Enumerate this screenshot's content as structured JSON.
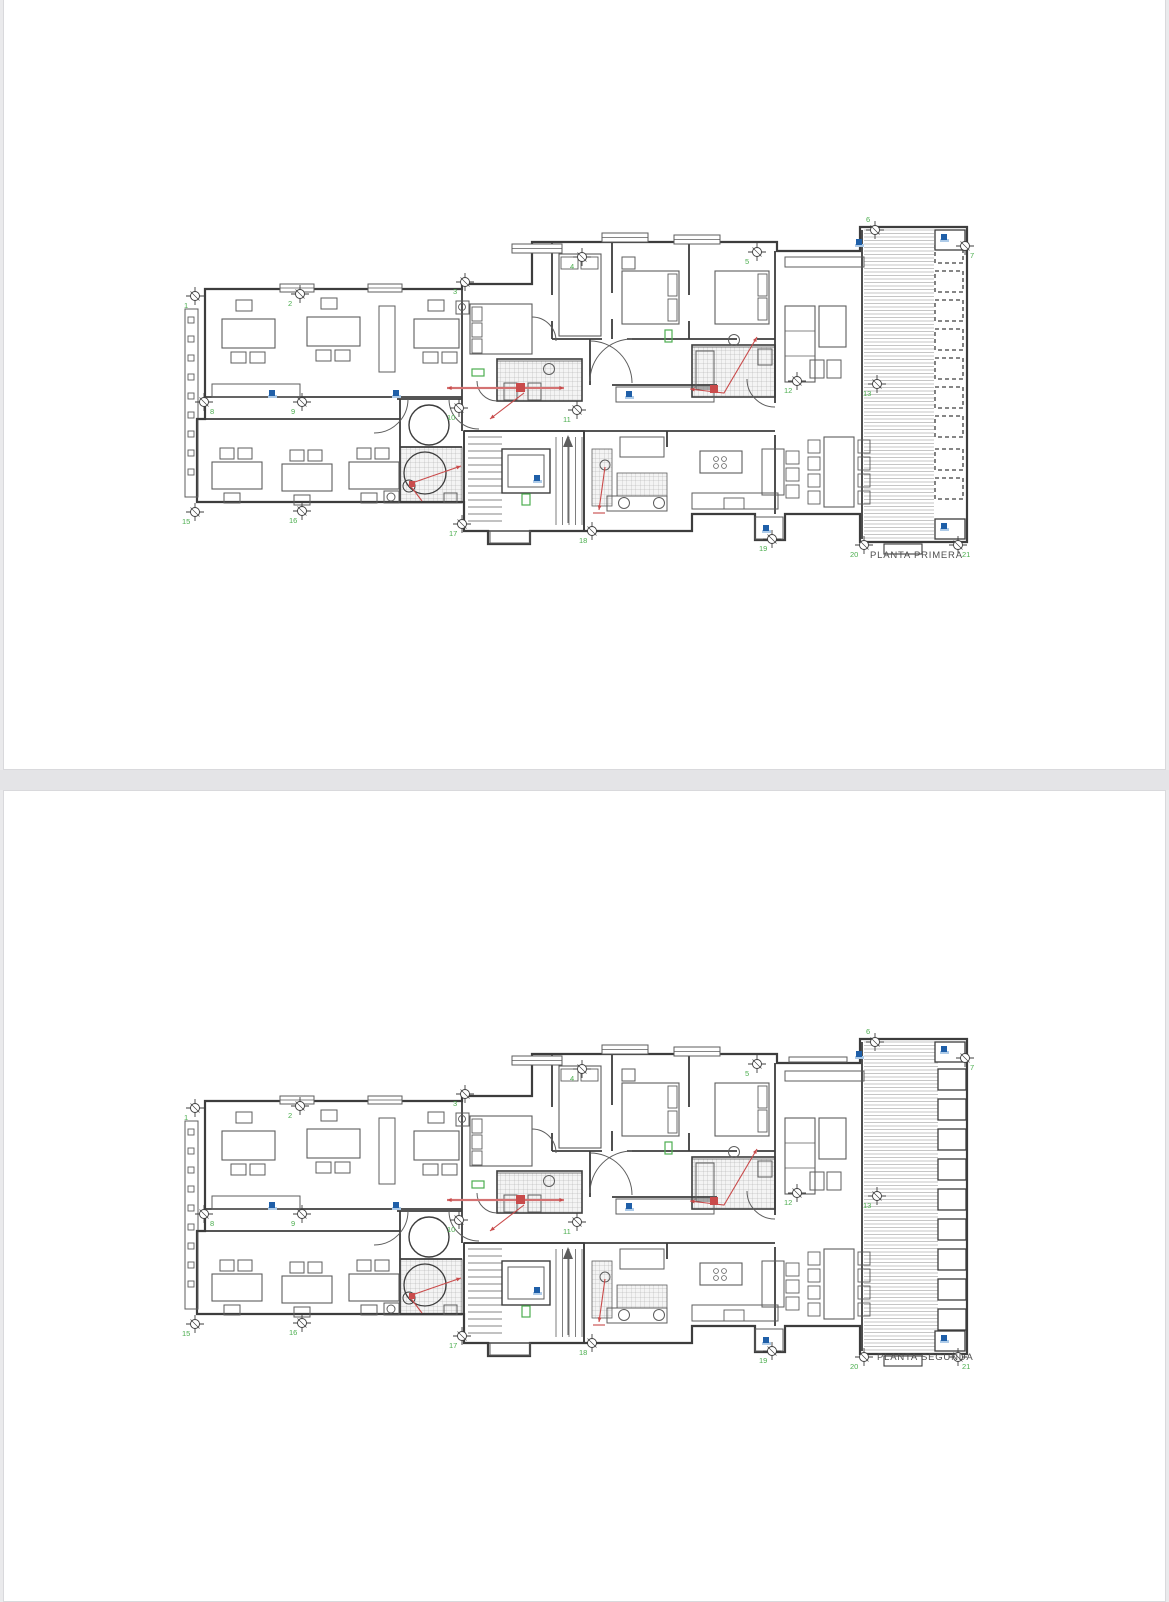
{
  "colors": {
    "wall_line": "#3d3d3d",
    "furniture_line": "#5d5d5d",
    "grid_green": "#4cae4f",
    "annotation_red": "#c94b4b",
    "annotation_red_light": "#e09a9a",
    "marker_blue": "#1f5fa8",
    "marker_blue_light": "#aecbe8",
    "hatch_line": "#a9a9a9",
    "hatch_bg": "#f4f4f4",
    "deck_line": "#b2b2b2",
    "label_text": "#4f4f4f",
    "page_bg": "#ffffff",
    "page_border": "#d9d9dc",
    "gap_bg": "#e4e4e7"
  },
  "grid_markers": [
    {
      "n": "1",
      "cx": 23,
      "cy": 99,
      "lx": 12,
      "ly": 111
    },
    {
      "n": "2",
      "cx": 128,
      "cy": 97,
      "lx": 116,
      "ly": 109
    },
    {
      "n": "3",
      "cx": 293,
      "cy": 85,
      "lx": 281,
      "ly": 97
    },
    {
      "n": "4",
      "cx": 410,
      "cy": 60,
      "lx": 398,
      "ly": 72
    },
    {
      "n": "5",
      "cx": 585,
      "cy": 55,
      "lx": 573,
      "ly": 67
    },
    {
      "n": "6",
      "cx": 703,
      "cy": 33,
      "lx": 694,
      "ly": 25
    },
    {
      "n": "7",
      "cx": 793,
      "cy": 49,
      "lx": 798,
      "ly": 61
    },
    {
      "n": "8",
      "cx": 32,
      "cy": 205,
      "lx": 38,
      "ly": 217
    },
    {
      "n": "9",
      "cx": 130,
      "cy": 205,
      "lx": 119,
      "ly": 217
    },
    {
      "n": "10",
      "cx": 287,
      "cy": 211,
      "lx": 275,
      "ly": 223
    },
    {
      "n": "11",
      "cx": 405,
      "cy": 213,
      "lx": 391,
      "ly": 225
    },
    {
      "n": "12",
      "cx": 625,
      "cy": 184,
      "lx": 612,
      "ly": 196
    },
    {
      "n": "13",
      "cx": 705,
      "cy": 187,
      "lx": 691,
      "ly": 199
    },
    {
      "n": "15",
      "cx": 23,
      "cy": 315,
      "lx": 10,
      "ly": 327
    },
    {
      "n": "16",
      "cx": 130,
      "cy": 314,
      "lx": 117,
      "ly": 326
    },
    {
      "n": "17",
      "cx": 290,
      "cy": 327,
      "lx": 277,
      "ly": 339
    },
    {
      "n": "18",
      "cx": 420,
      "cy": 334,
      "lx": 407,
      "ly": 346
    },
    {
      "n": "19",
      "cx": 600,
      "cy": 342,
      "lx": 587,
      "ly": 354
    },
    {
      "n": "20",
      "cx": 692,
      "cy": 348,
      "lx": 678,
      "ly": 360
    },
    {
      "n": "21",
      "cx": 786,
      "cy": 348,
      "lx": 790,
      "ly": 360
    }
  ],
  "pages": [
    {
      "plan_label": "PLANTA PRIMERA",
      "terrace": {
        "planter_style": "dashed"
      }
    },
    {
      "plan_label": "PLANTA SEGUNDA",
      "terrace": {
        "planter_style": "solid"
      }
    }
  ]
}
